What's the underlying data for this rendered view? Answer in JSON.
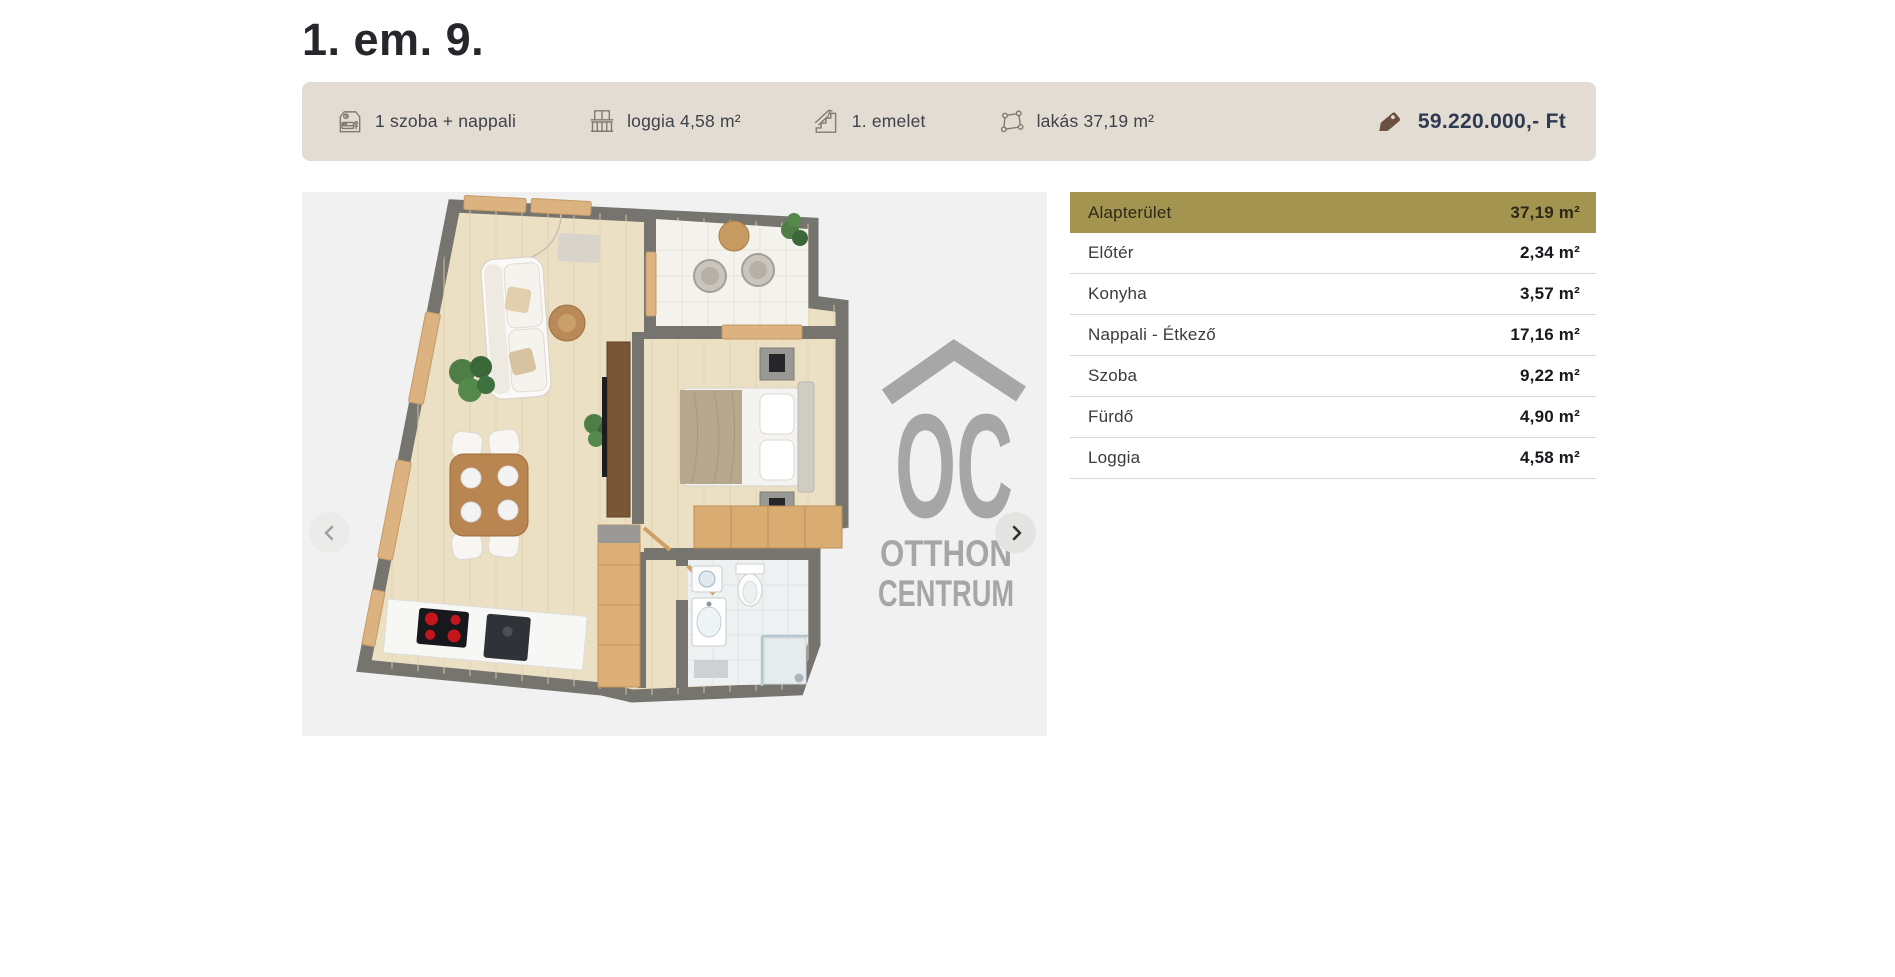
{
  "page": {
    "title": "1. em. 9."
  },
  "summary_bar": {
    "items": [
      {
        "icon": "bedroom-icon",
        "label": "1 szoba + nappali"
      },
      {
        "icon": "balcony-icon",
        "label": "loggia 4,58 m²"
      },
      {
        "icon": "stairs-icon",
        "label": "1. emelet"
      },
      {
        "icon": "floor-area-icon",
        "label": "lakás 37,19 m²"
      }
    ],
    "price": "59.220.000,- Ft"
  },
  "floorplan": {
    "watermark": {
      "logo_text": "OC",
      "line1": "OTTHON",
      "line2": "CENTRUM"
    }
  },
  "area_table": {
    "rows": [
      {
        "label": "Alapterület",
        "value": "37,19 m²",
        "highlight": true
      },
      {
        "label": "Előtér",
        "value": "2,34 m²"
      },
      {
        "label": "Konyha",
        "value": "3,57 m²"
      },
      {
        "label": "Nappali - Étkező",
        "value": "17,16 m²"
      },
      {
        "label": "Szoba",
        "value": "9,22 m²"
      },
      {
        "label": "Fürdő",
        "value": "4,90 m²"
      },
      {
        "label": "Loggia",
        "value": "4,58 m²"
      }
    ]
  },
  "colors": {
    "bar_bg": "#e3dcd2",
    "highlight_row_bg": "#a39550",
    "price_text": "#2e3a52",
    "price_tag": "#6b4f41",
    "summary_text": "#3e424b",
    "plan_bg": "#f1f1f1",
    "watermark_gray": "#9c9c9c"
  }
}
